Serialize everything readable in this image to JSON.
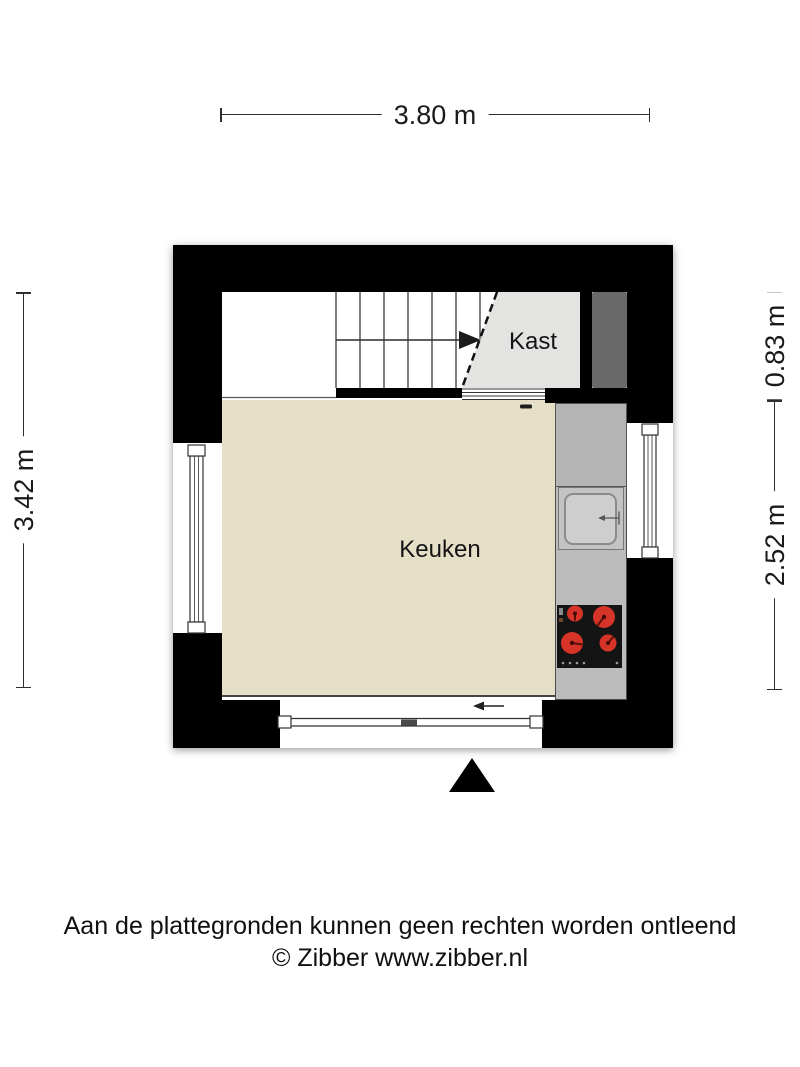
{
  "footer": {
    "disclaimer": "Aan de plattegronden kunnen geen rechten worden ontleend",
    "copyright": "© Zibber www.zibber.nl"
  },
  "dimensions": {
    "width_total": "3.80 m",
    "height_total": "3.42 m",
    "upper_right": "0.83 m",
    "lower_right": "2.52 m"
  },
  "rooms": {
    "kitchen": {
      "label": "Keuken"
    },
    "closet": {
      "label": "Kast"
    }
  },
  "colors": {
    "wall": "#000000",
    "kitchen_floor": "#e6dfc8",
    "closet_floor": "#e3e3e1",
    "counter": "#bcbcbc",
    "shaft": "#696969",
    "burner_red": "#d63428",
    "dimension_text": "#1a1a1a"
  }
}
